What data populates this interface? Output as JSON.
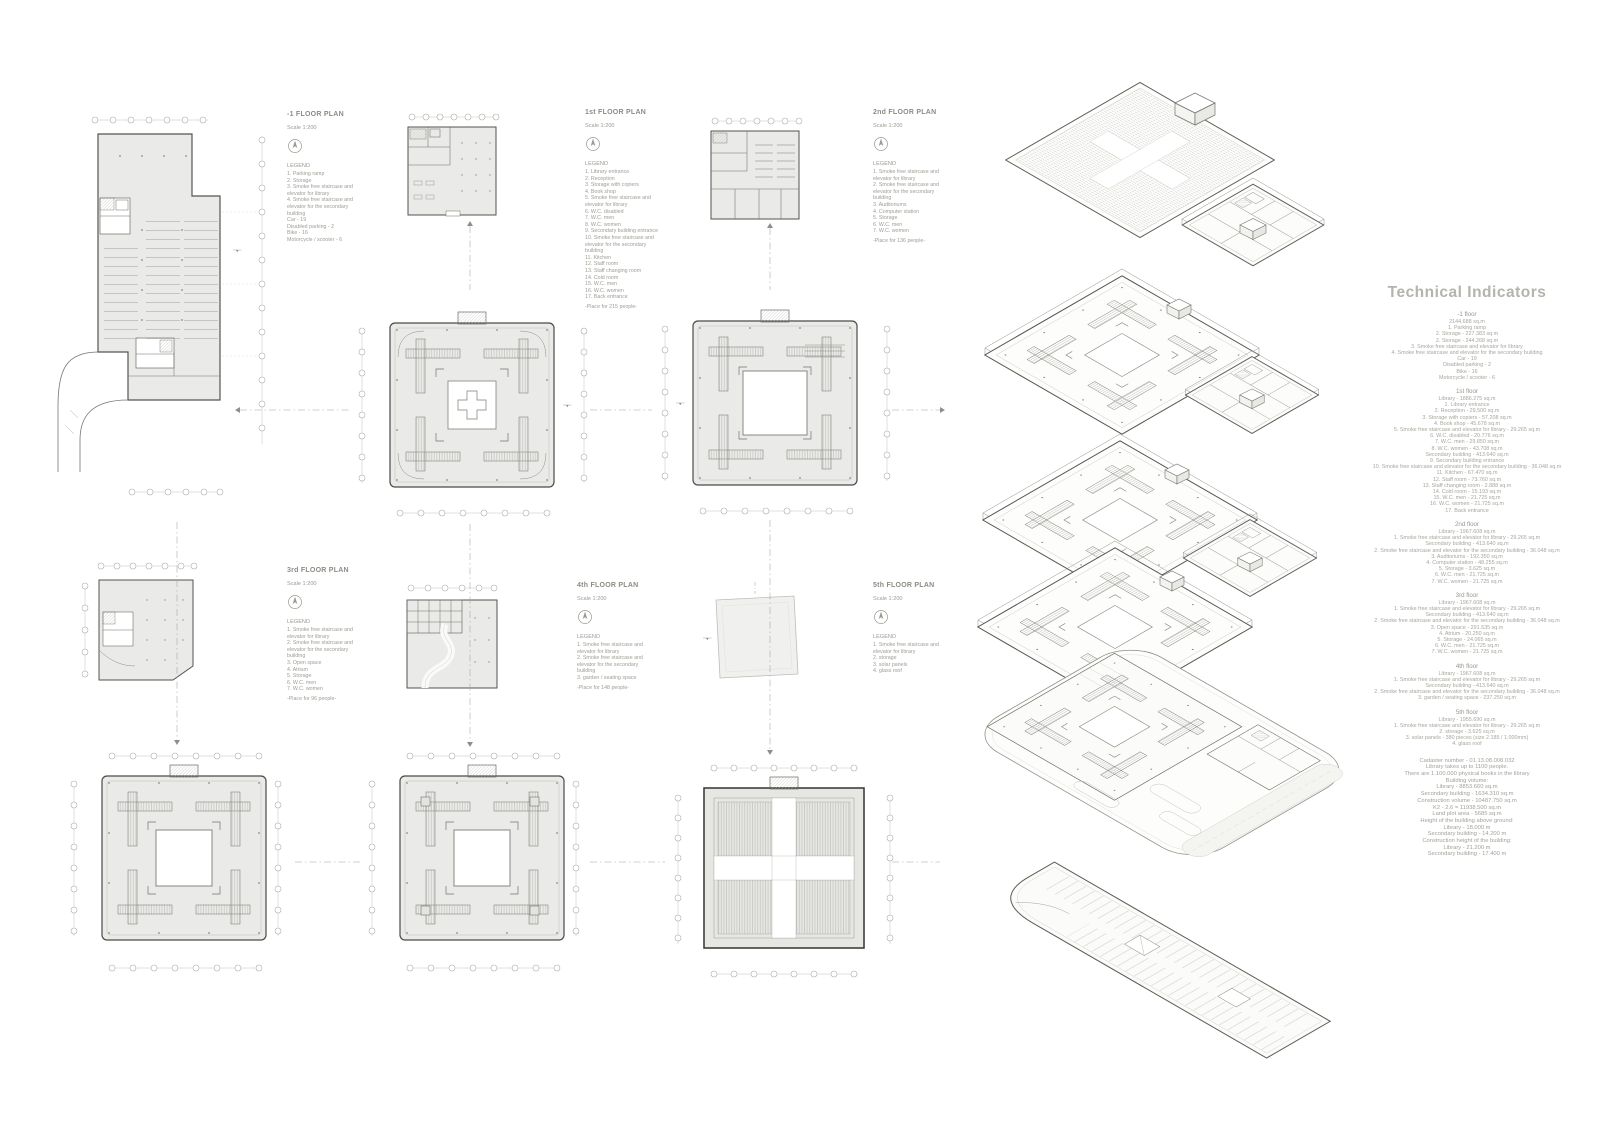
{
  "plans": [
    {
      "title": "-1 FLOOR PLAN",
      "scale": "Scale 1:200",
      "legend_label": "LEGEND",
      "legend": [
        "1. Parking ramp",
        "2. Storage",
        "3. Smoke free staircase and elevator for library",
        "4. Smoke free staircase and elevator for the secondary building",
        "Car - 19",
        "Disabled parking - 2",
        "Bike - 16",
        "Motorcycle / scooter - 6"
      ],
      "note": ""
    },
    {
      "title": "1st FLOOR PLAN",
      "scale": "Scale 1:200",
      "legend_label": "LEGEND",
      "legend": [
        "1. Library entrance",
        "2. Reception",
        "3. Storage with copiers",
        "4. Book shop",
        "5. Smoke free staircase and elevator for library",
        "6. W.C. disabled",
        "7. W.C. men",
        "8. W.C. women",
        "9. Secondary building entrance",
        "10. Smoke free staircase and elevator for the secondary building",
        "11. Kitchen",
        "12. Staff room",
        "13. Staff changing room",
        "14. Cold room",
        "15. W.C. men",
        "16. W.C. women",
        "17. Back entrance"
      ],
      "note": "-Place for 215 people-"
    },
    {
      "title": "2nd FLOOR PLAN",
      "scale": "Scale 1:200",
      "legend_label": "LEGEND",
      "legend": [
        "1. Smoke free staircase and elevator for library",
        "2. Smoke free staircase and elevator for the secondary building",
        "3. Auditoriums",
        "4. Computer station",
        "5. Storage",
        "6. W.C. men",
        "7. W.C. women"
      ],
      "note": "-Place for 136 people-"
    },
    {
      "title": "3rd FLOOR PLAN",
      "scale": "Scale 1:200",
      "legend_label": "LEGEND",
      "legend": [
        "1. Smoke free staircase and elevator for library",
        "2. Smoke free staircase and elevator for the secondary building",
        "3. Open space",
        "4. Atrium",
        "5. Storage",
        "6. W.C. men",
        "7. W.C. women"
      ],
      "note": "-Place for 96 people-"
    },
    {
      "title": "4th FLOOR PLAN",
      "scale": "Scale 1:200",
      "legend_label": "LEGEND",
      "legend": [
        "1. Smoke free staircase and elevator for library",
        "2. Smoke free staircase and elevator for the secondary building",
        "3. garden / seating space"
      ],
      "note": "-Place for 148 people-"
    },
    {
      "title": "5th FLOOR PLAN",
      "scale": "Scale 1:200",
      "legend_label": "LEGEND",
      "legend": [
        "1. Smoke free staircase and elevator for library",
        "2. storage",
        "3. solar panels",
        "4. glass roof"
      ],
      "note": ""
    }
  ],
  "technical": {
    "title": "Technical Indicators",
    "sections": [
      {
        "heading": "-1 floor",
        "lines": [
          "2144.688 sq.m",
          "1. Parking ramp",
          "2. Storage - 227.383 sq.m",
          "2. Storage - 244.268 sq.m",
          "3. Smoke free staircase and elevator for library",
          "4. Smoke free staircase and elevator for the secondary building",
          "Car - 19",
          "Disabled parking - 2",
          "Bike - 16",
          "Motorcycle / scooter - 6"
        ]
      },
      {
        "heading": "1st floor",
        "lines": [
          "Library - 1886.275 sq.m",
          "1. Library entrance",
          "2. Reception - 29.500 sq.m",
          "3. Storage with copiers - 57.208 sq.m",
          "4. Book shop - 45.678 sq.m",
          "5. Smoke free staircase and elevator for library - 29.265 sq.m",
          "6. W.C. disabled - 20.776 sq.m",
          "7. W.C. men - 29.850 sq.m",
          "8. W.C. women - 43.708 sq.m",
          "Secondary building - 413.640 sq.m",
          "9. Secondary building entrance",
          "10. Smoke free staircase and elevator for the secondary building - 36.048 sq.m",
          "11. Kitchen - 67.470 sq.m",
          "12. Staff room - 73.760 sq.m",
          "13. Staff changing room - 2.888 sq.m",
          "14. Cold room - 15.193 sq.m",
          "15. W.C. men - 21.725 sq.m",
          "16. W.C. women - 21.725 sq.m",
          "17. Back entrance"
        ]
      },
      {
        "heading": "2nd floor",
        "lines": [
          "Library - 1967.608 sq.m",
          "1. Smoke free staircase and elevator for library - 29.265 sq.m",
          "Secondary building - 413.640 sq.m",
          "2. Smoke free staircase and elevator for the secondary building - 36.048 sq.m",
          "3. Auditoriums - 192.350 sq.m",
          "4. Computer station - 48.255 sq.m",
          "5. Storage - 3.625 sq.m",
          "6. W.C. men - 21.725 sq.m",
          "7. W.C. women - 21.725 sq.m"
        ]
      },
      {
        "heading": "3rd floor",
        "lines": [
          "Library - 1967.608 sq.m",
          "1. Smoke free staircase and elevator for library - 29.265 sq.m",
          "Secondary building - 413.640 sq.m",
          "2. Smoke free staircase and elevator for the secondary building - 36.048 sq.m",
          "3. Open space - 291.535 sq.m",
          "4. Atrium - 20.250 sq.m",
          "5. Storage - 24.065 sq.m",
          "6. W.C. men - 21.725 sq.m",
          "7. W.C. women - 21.725 sq.m"
        ]
      },
      {
        "heading": "4th floor",
        "lines": [
          "Library - 1967.608 sq.m",
          "1. Smoke free staircase and elevator for library - 29.265 sq.m",
          "Secondary building - 413.640 sq.m",
          "2. Smoke free staircase and elevator for the secondary building - 36.048 sq.m",
          "3. garden / seating space - 237.250 sq.m"
        ]
      },
      {
        "heading": "5th floor",
        "lines": [
          "Library - 1955.690 sq.m",
          "1. Smoke free staircase and elevator for library - 29.265 sq.m",
          "2. storage - 3.625 sq.m",
          "3. solar panels - 380 pieces (size 2.185 / 1.000mm)",
          "4. glass roof"
        ]
      }
    ],
    "summary": [
      "Cadaster number - 01.13.08.008.032",
      "Library takes up to 1100 people.",
      "There are 1.100.000 physical books in the library",
      "Building volume:",
      "Library - 8853.660 sq.m",
      "Secondary building - 1634.310 sq.m",
      "Construction volume - 10487.750 sq.m",
      "K2 - 2.6 = 11938.500 sq.m",
      "Land plot area - 5685 sq.m",
      "Height of the building above ground:",
      "Library - 18.000 m",
      "Secondary building - 14.200 m",
      "Construction height of the building:",
      "Library - 21.200 m",
      "Secondary building - 17.400 m"
    ]
  }
}
